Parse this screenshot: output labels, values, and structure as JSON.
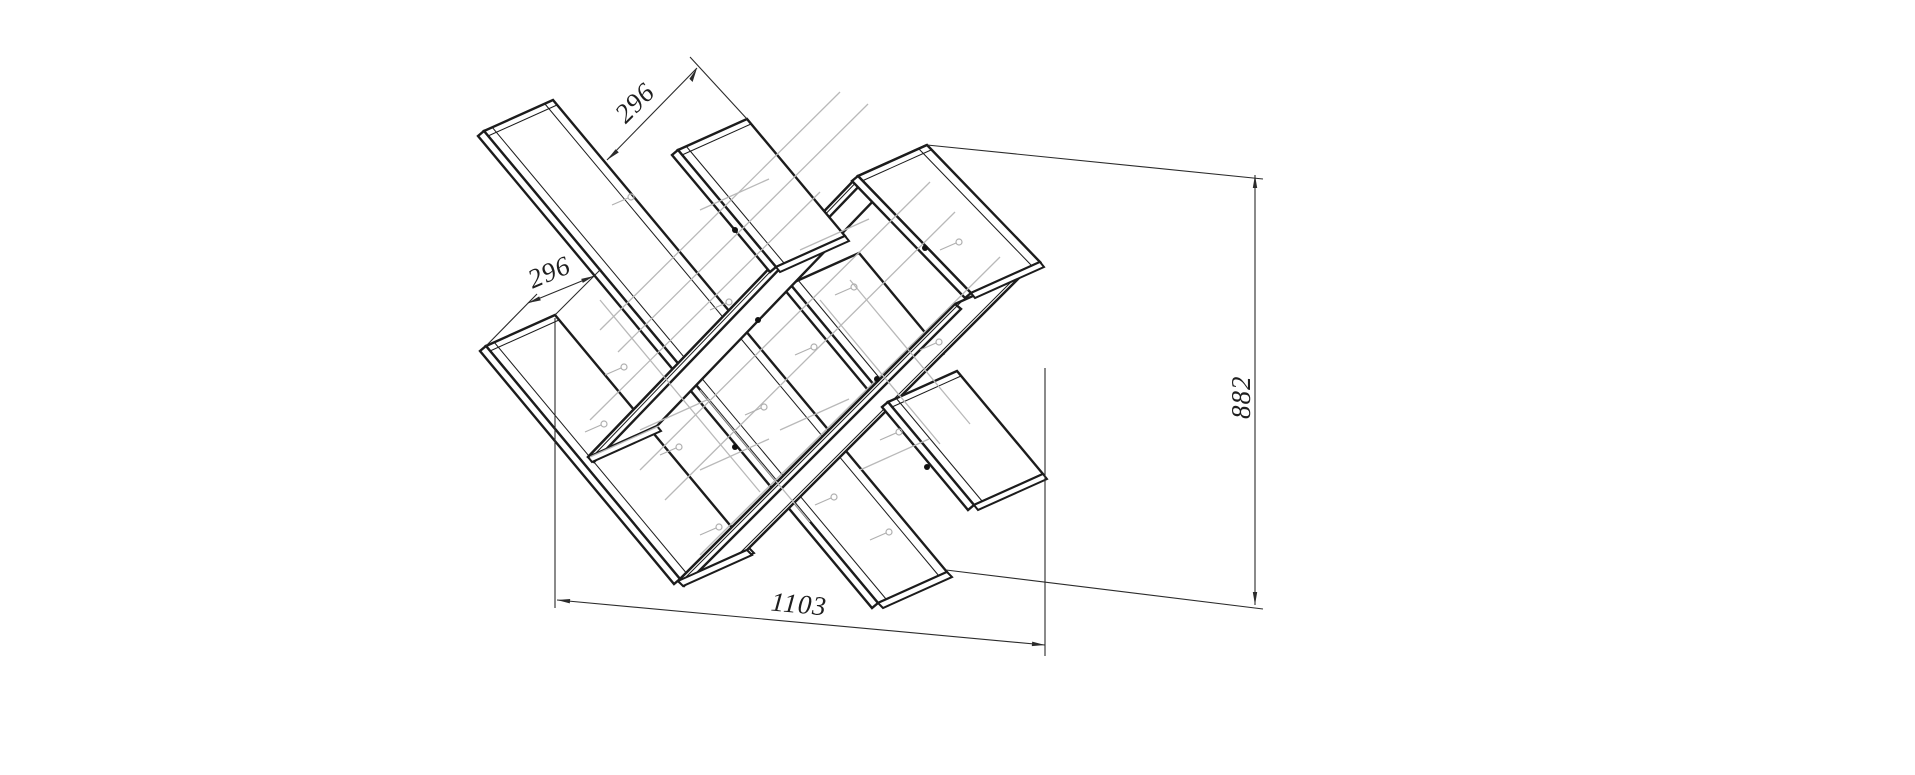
{
  "drawing": {
    "type": "isometric-technical-drawing",
    "subject": "zigzag X-shelf unit",
    "background": "#ffffff",
    "line_colors": {
      "visible": "#1c1c1c",
      "hidden": "#b9b9b9",
      "dimension": "#2b2b2b"
    },
    "dimensions": {
      "top_shelf_depth": "296",
      "left_shelf_depth": "296",
      "overall_width": "1103",
      "overall_height": "882"
    }
  }
}
